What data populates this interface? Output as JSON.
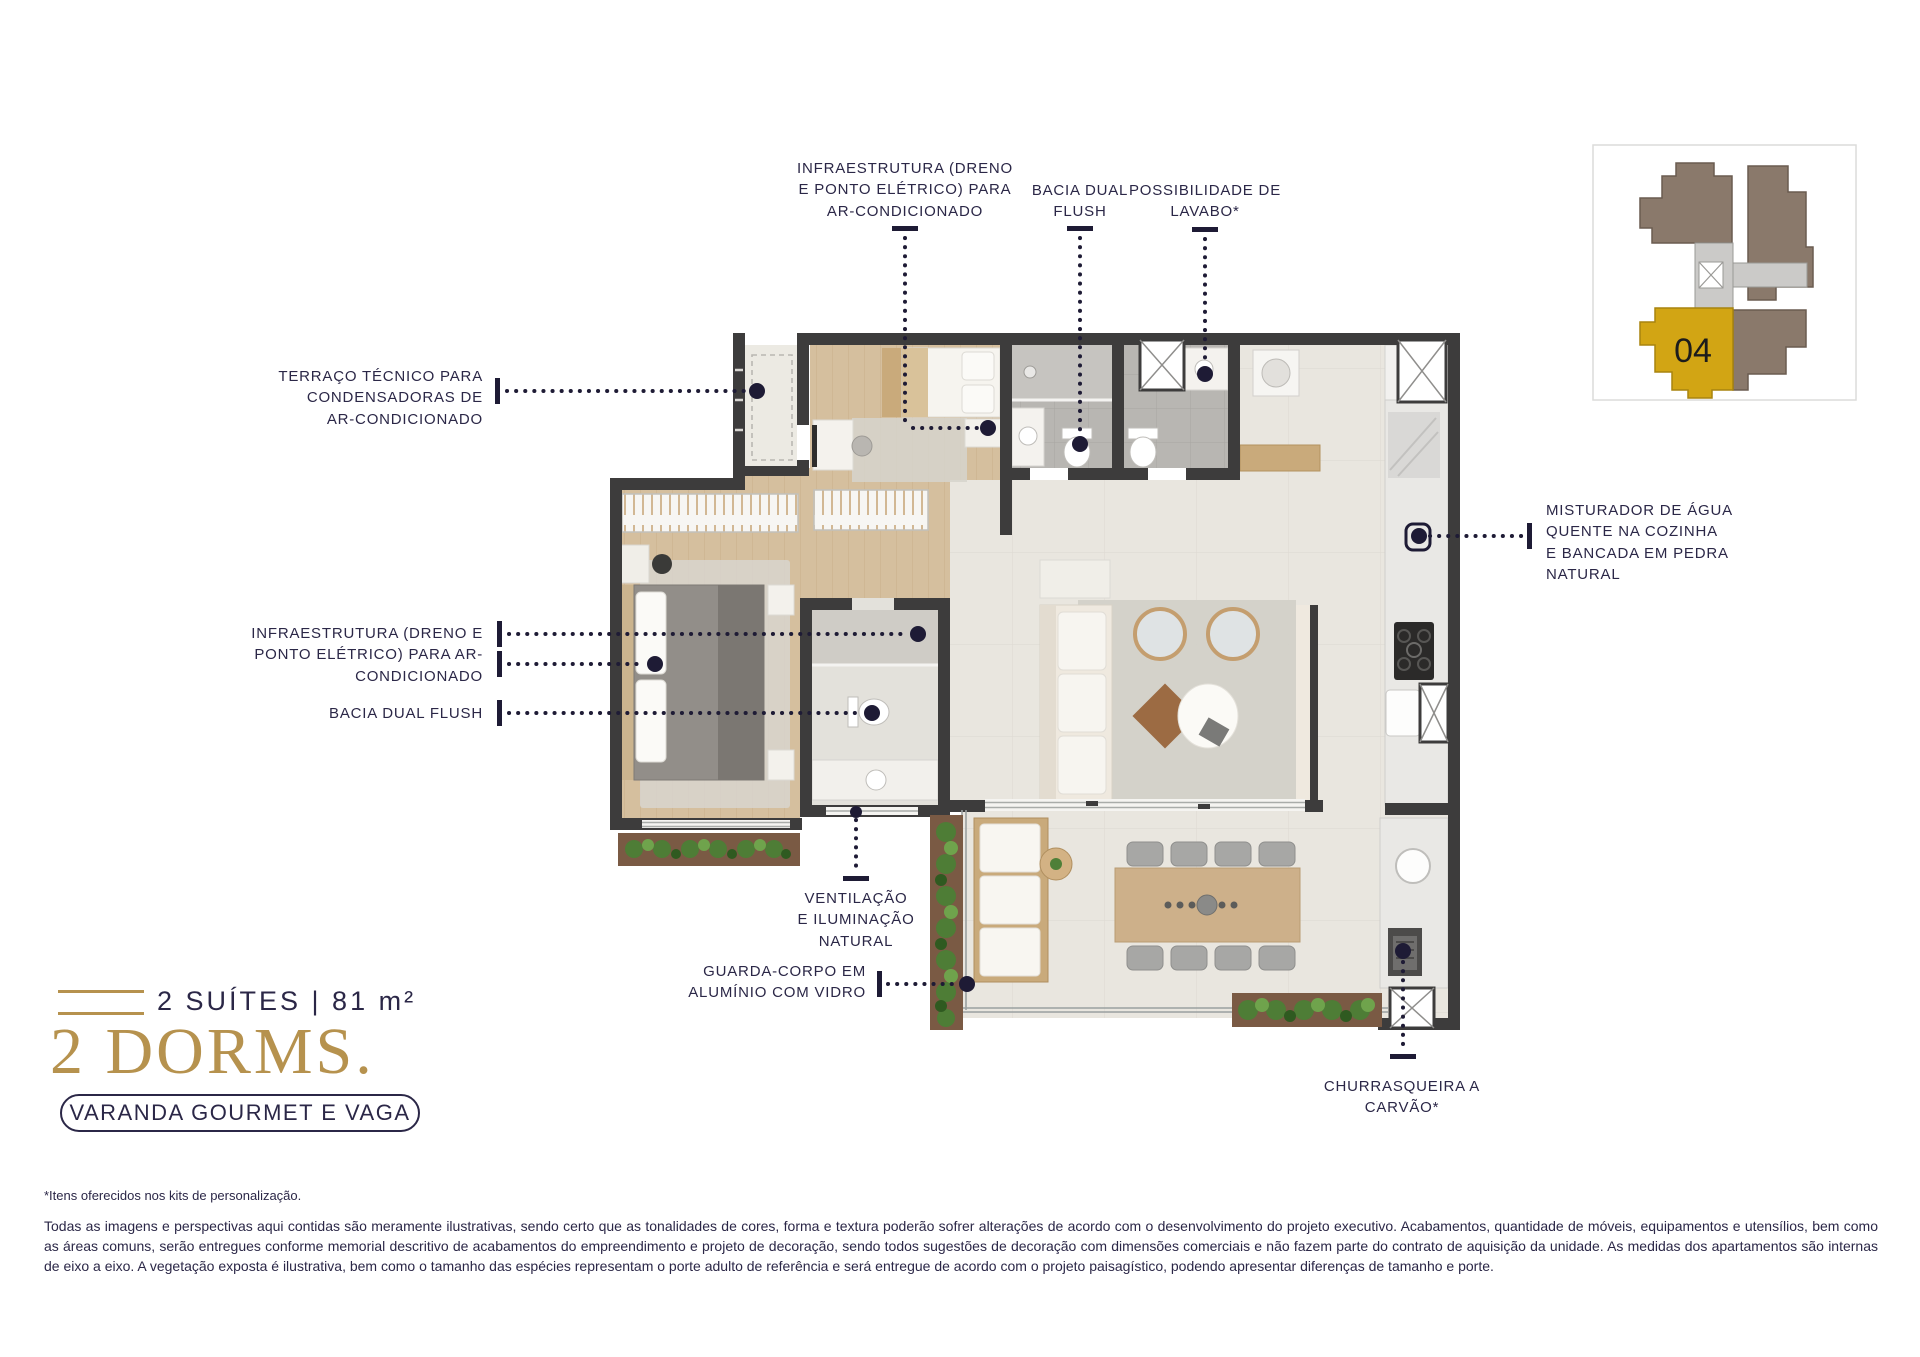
{
  "callouts": {
    "infra_ac_top": "INFRAESTRUTURA (DRENO\nE PONTO ELÉTRICO) PARA\nAR-CONDICIONADO",
    "bacia_top": "BACIA DUAL\nFLUSH",
    "lavabo": "POSSIBILIDADE DE\nLAVABO*",
    "terraco": "TERRAÇO TÉCNICO PARA\nCONDENSADORAS DE\nAR-CONDICIONADO",
    "infra_ac_left": "INFRAESTRUTURA (DRENO E\nPONTO ELÉTRICO) PARA AR-\nCONDICIONADO",
    "bacia_left": "BACIA DUAL FLUSH",
    "misturador": "MISTURADOR DE ÁGUA\nQUENTE NA COZINHA\nE BANCADA EM PEDRA\nNATURAL",
    "ventilacao": "VENTILAÇÃO\nE ILUMINAÇÃO\nNATURAL",
    "guarda_corpo": "GUARDA-CORPO EM\nALUMÍNIO COM VIDRO",
    "churrasqueira": "CHURRASQUEIRA A\nCARVÃO*"
  },
  "title_block": {
    "suites_line": "2 SUÍTES | 81 m²",
    "dorms_line": "2 DORMS.",
    "badge": "VARANDA GOURMET E VAGA"
  },
  "key_plan": {
    "unit_number": "04",
    "unit_color": "#d2a514",
    "building_color": "#8a796b",
    "core_color": "#cbcac8"
  },
  "footnotes": {
    "kits": "*Itens oferecidos nos kits de personalização.",
    "disclaimer": "Todas as imagens e perspectivas aqui contidas são meramente ilustrativas, sendo certo que as tonalidades de cores, forma e textura poderão sofrer alterações de acordo com o desenvolvimento do projeto executivo. Acabamentos, quantidade de móveis, equipamentos e utensílios, bem como as áreas comuns, serão entregues conforme memorial descritivo de acabamentos do empreendimento e projeto de decoração, sendo todos sugestões de decoração com dimensões comerciais e não fazem parte do contrato de aquisição da unidade. As medidas dos apartamentos são internas de eixo a eixo. A vegetação exposta é ilustrativa, bem como o tamanho das espécies representam o porte adulto de referência e será entregue de acordo com o projeto paisagístico, podendo apresentar diferenças de tamanho e porte."
  },
  "colors": {
    "accent_gold": "#b6924e",
    "label_navy": "#2b2747",
    "wall": "#3d3c3c"
  }
}
